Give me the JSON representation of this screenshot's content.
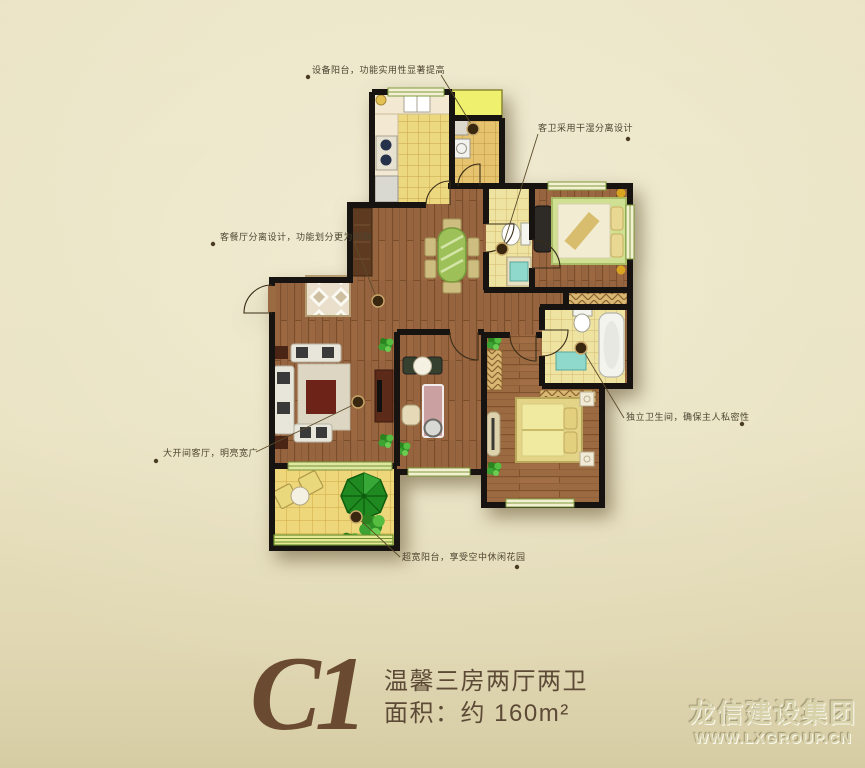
{
  "annotations": [
    {
      "id": "equipment-balcony",
      "text": "设备阳台，功能实用性显著提高"
    },
    {
      "id": "guest-bathroom",
      "text": "客卫采用干湿分离设计"
    },
    {
      "id": "dining-living-split",
      "text": "客餐厅分离设计，功能划分更为明确"
    },
    {
      "id": "living-room",
      "text": "大开间客厅，明亮宽广"
    },
    {
      "id": "wide-balcony",
      "text": "超宽阳台，享受空中休闲花园"
    },
    {
      "id": "master-bathroom",
      "text": "独立卫生间，确保主人私密性"
    }
  ],
  "title": {
    "code": "C1",
    "layout": "温馨三房两厅两卫",
    "area": "面积：约 160m²"
  },
  "watermark": {
    "company": "龙信建设集团",
    "website": "WWW.LXGROUP.CN"
  },
  "colors": {
    "paper": "#e9e2c2",
    "wall": "#161310",
    "wood_floor": "#96653c",
    "tile_kitchen": "#ecd87f",
    "tile_bath": "#efe3a2",
    "tile_balcony": "#eed77a",
    "equipment_balcony_yellow": "#eef06e",
    "umbrella_green": "#1f8a1f",
    "dining_table_green": "#9dc158",
    "title_brown": "#6a4a30",
    "annotation_text": "#4e4430",
    "watermark_tone": "#d8d2ab"
  }
}
